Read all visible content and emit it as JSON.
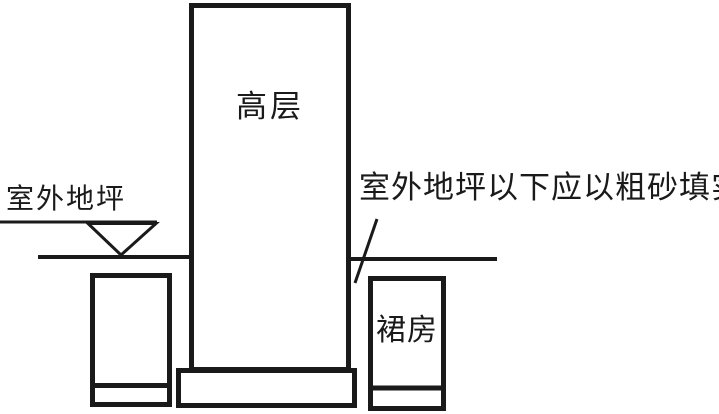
{
  "diagram": {
    "type": "construction-detail-sketch",
    "background_color": "#ffffff",
    "line_color": "#1a1a1a",
    "labels": {
      "high_rise": "高层",
      "podium": "裙房",
      "outdoor_ground": "室外地坪",
      "annotation": "室外地坪以下应以粗砂填实"
    },
    "symbols": {
      "level_marker": "inverted-triangle-ground-level-symbol"
    }
  }
}
